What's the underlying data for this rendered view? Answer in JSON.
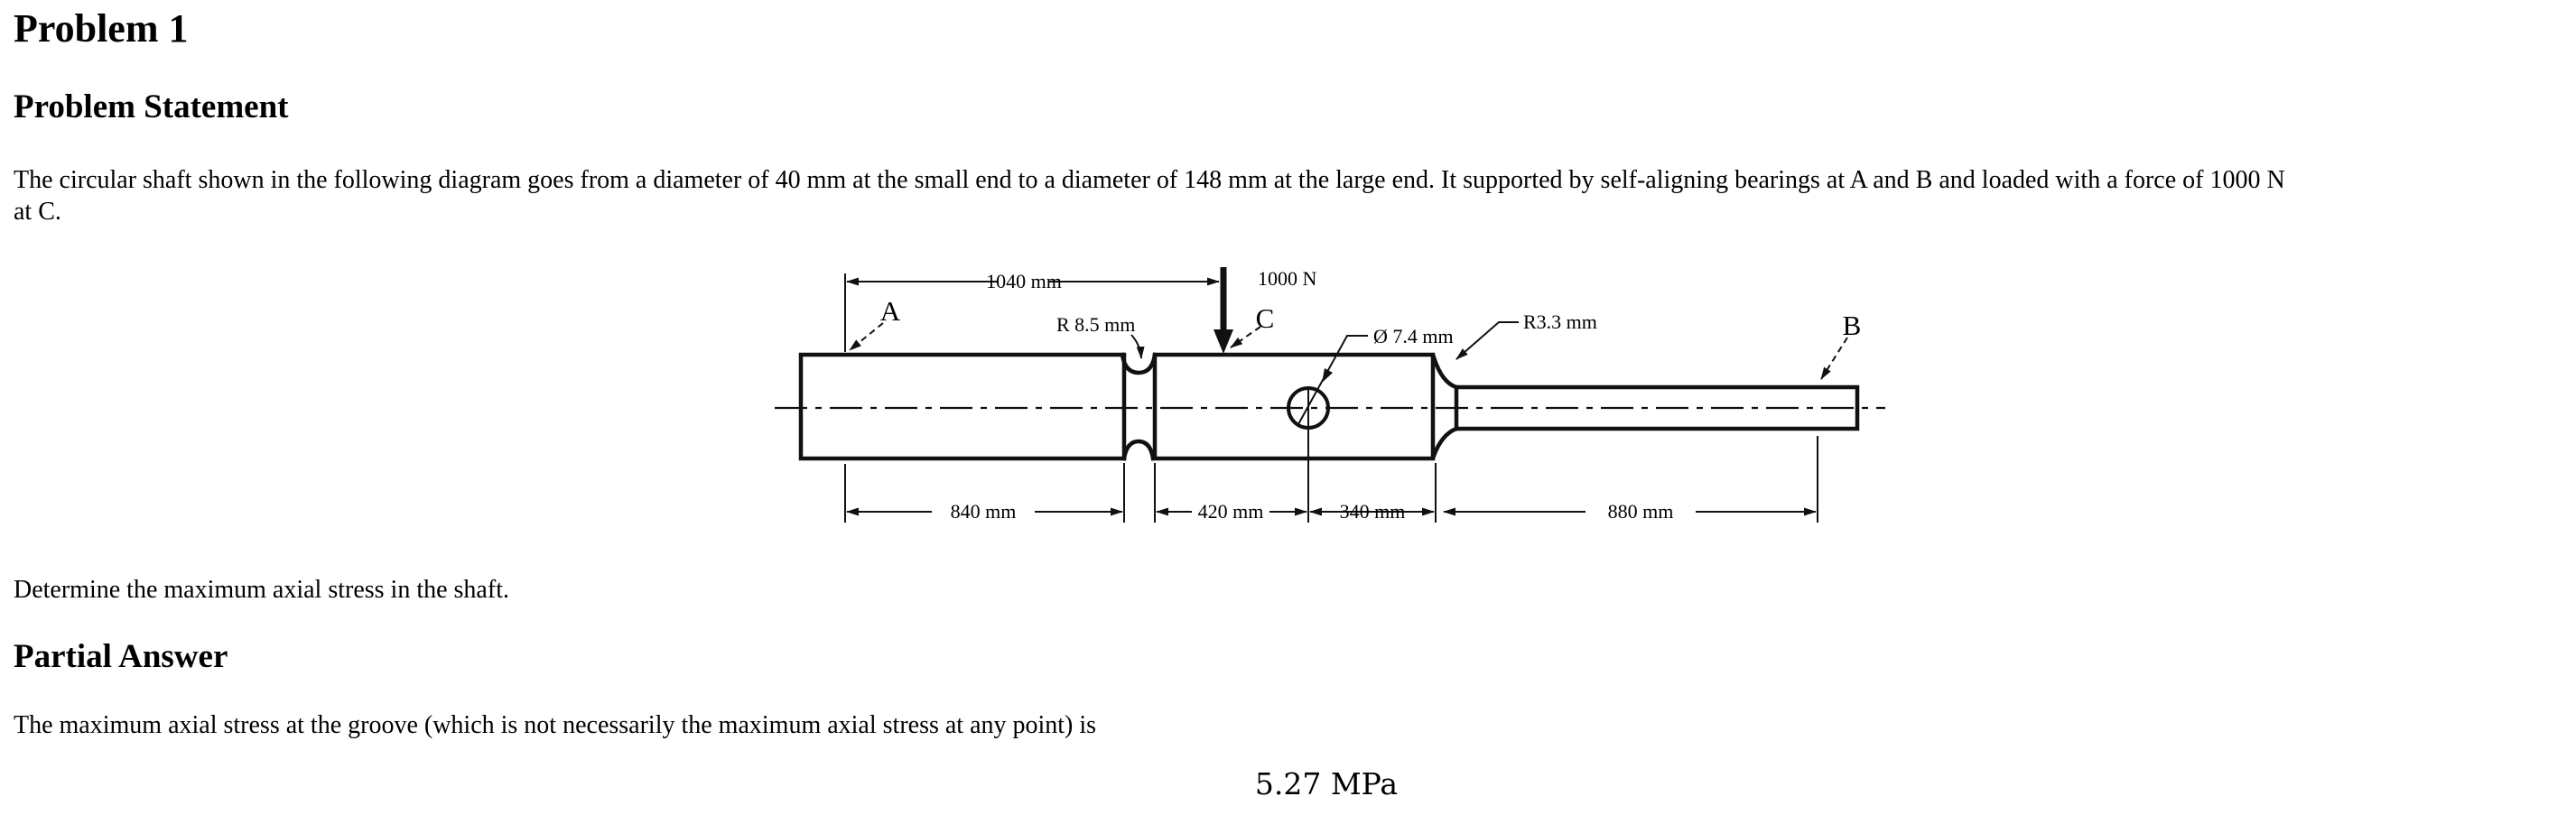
{
  "document": {
    "title": "Problem 1",
    "problem_statement": {
      "heading": "Problem Statement",
      "line1": "The circular shaft shown in the following diagram goes from a diameter of 40 mm at the small end to a diameter of 148 mm at the large end. It supported by self-aligning bearings at A and B and loaded with a force of 1000 N",
      "line2": "at C."
    },
    "diagram": {
      "labels": {
        "bearing_a": "A",
        "point_c": "C",
        "bearing_b": "B",
        "force": "1000 N",
        "groove_radius": "R 8.5 mm",
        "hole_diameter": "Ø 7.4 mm",
        "fillet_radius": "R3.3 mm"
      },
      "dimensions": {
        "top_span": "1040 mm",
        "left_section": "840 mm",
        "mid_left": "420 mm",
        "mid_right": "340 mm",
        "right_section": "880 mm"
      }
    },
    "question": "Determine the maximum axial stress in the shaft.",
    "partial_answer": {
      "heading": "Partial Answer",
      "body": "The maximum axial stress at the groove (which is not necessarily the maximum axial stress at any point) is",
      "value": "5.27 MPa"
    }
  }
}
